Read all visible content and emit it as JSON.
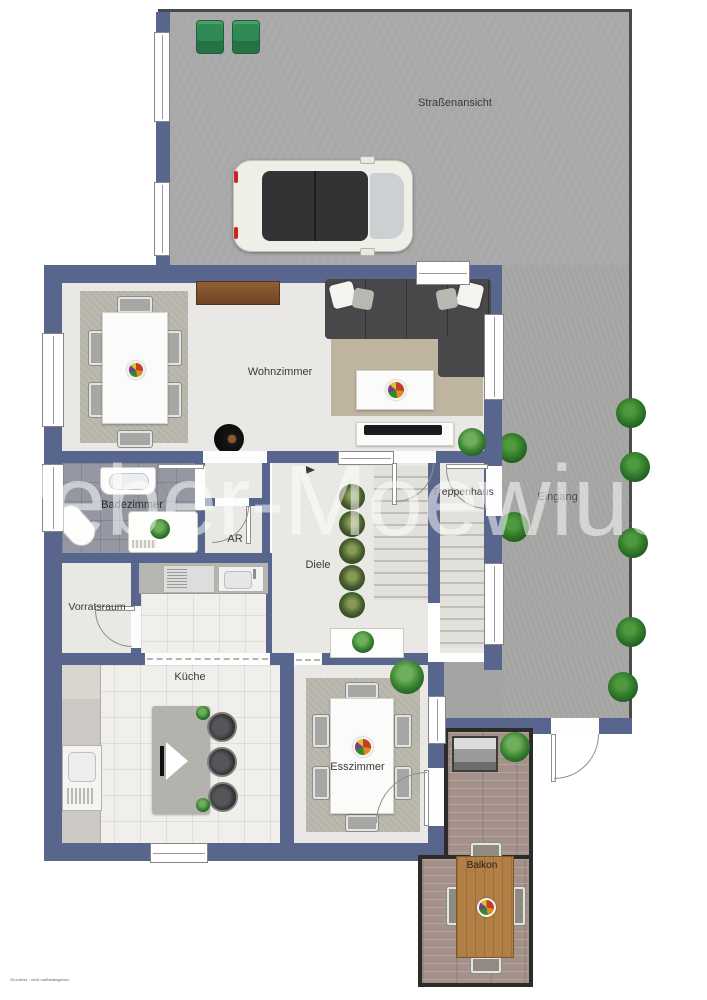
{
  "watermark": "Weber-Moewius",
  "labels": {
    "strassenansicht": "Straßenansicht",
    "eingang": "Eingang",
    "wohnzimmer": "Wohnzimmer",
    "badezimmer": "Badezimmer",
    "abstellraum": "AR",
    "treppenhaus": "Treppenhaus",
    "diele": "Diele",
    "vorratsraum": "Vorratsraum",
    "kueche": "Küche",
    "esszimmer": "Esszimmer",
    "balkon": "Balkon"
  },
  "footer_note": "Grundriss - nicht maßstabsgetreu",
  "colors": {
    "wall": "#58668e",
    "driveway": "#a8a8a8",
    "entry_paving": "#a4a4a2",
    "floor": "#e9e8e4",
    "bath_tiles": "#9598a3",
    "deck_wood": "#a3918a",
    "balcony_table_wood": "#b28045",
    "plant_green": "#2c7427",
    "sofa_gray": "#48484a"
  }
}
